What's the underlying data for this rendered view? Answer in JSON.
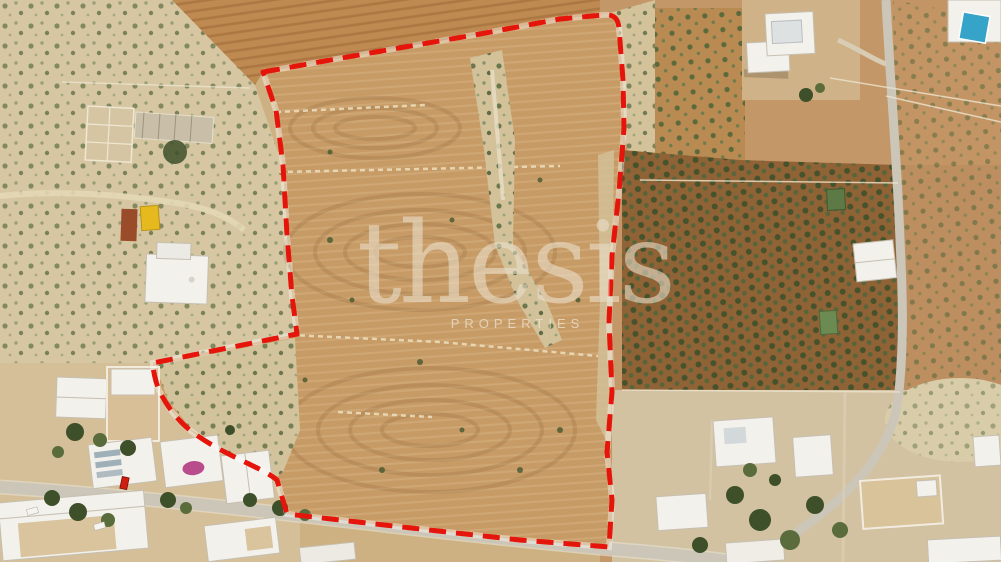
{
  "watermark": {
    "brand": "thesis",
    "tagline": "PROPERTIES"
  },
  "colors": {
    "boundary_red": "#e5150b",
    "boundary_halo": "#ffffff",
    "watermark_cream": "#e9e0cb",
    "pool_blue": "#36a3c9",
    "red_car": "#cf1d10",
    "white_car": "#f5f4f0",
    "yellow_container": "#e6ba1e",
    "rust_container": "#9a4c2a",
    "plot_field_tan": "#c79b66",
    "tilled_field_orange": "#bf8a52",
    "olive_grove_soil": "#8f6336",
    "scrub_pale": "#d7c8a3",
    "road_gray": "#ccc6b9",
    "building_white": "#f3f1ec"
  }
}
